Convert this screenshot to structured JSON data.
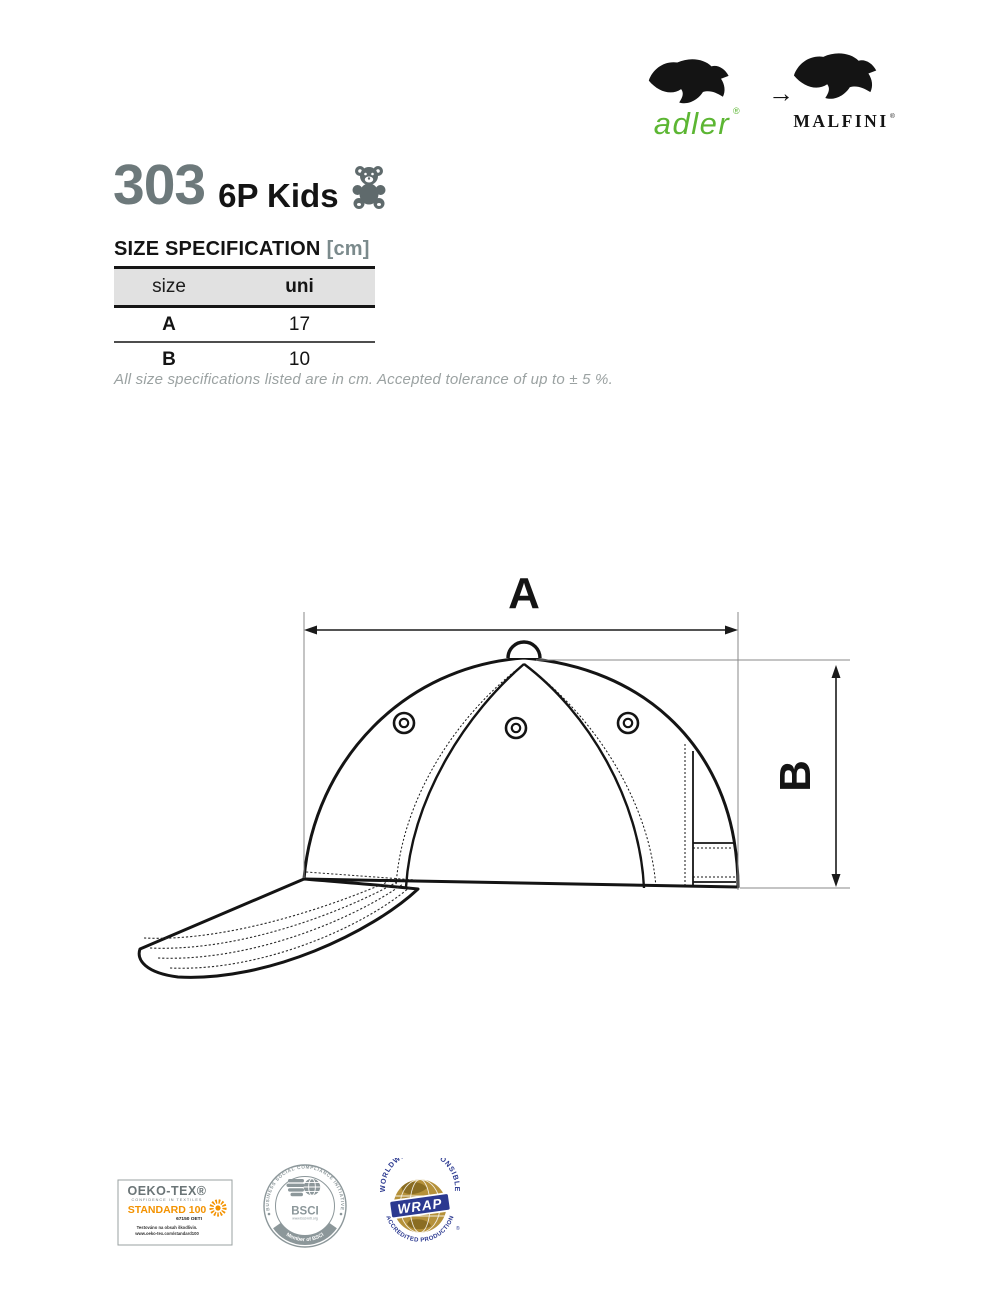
{
  "header": {
    "brand_from": {
      "name": "adler",
      "registered": "®",
      "color": "#5cb633"
    },
    "arrow": "→",
    "brand_to": {
      "name": "MALFINI",
      "registered": "®"
    }
  },
  "product": {
    "code": "303",
    "name": "6P Kids",
    "code_color": "#6d797b",
    "icon": "teddy-bear"
  },
  "size_spec": {
    "heading": "SIZE SPECIFICATION",
    "unit_label": "[cm]",
    "table": {
      "header": [
        "size",
        "uni"
      ],
      "rows": [
        [
          "A",
          "17"
        ],
        [
          "B",
          "10"
        ]
      ]
    },
    "note": "All size specifications listed are in cm. Accepted tolerance of up to ± 5 %."
  },
  "diagram": {
    "dim_a_label": "A",
    "dim_b_label": "B"
  },
  "certifications": {
    "oeko_tex": {
      "brand": "OEKO-TEX®",
      "subtitle": "CONFIDENCE IN TEXTILES",
      "standard": "STANDARD 100",
      "number": "67150 OETI",
      "line1": "Testováno na obsah škodlivin.",
      "line2": "www.oeko-tex.com/standard100",
      "orange": "#f39200",
      "gray": "#6b7577"
    },
    "bsci": {
      "ring_text": "BUSINESS SOCIAL COMPLIANCE INITIATIVE",
      "banner_text": "Member of BSCI",
      "center_label": "BSCI",
      "url": "www.bsci-intl.org",
      "color": "#8c979a"
    },
    "wrap": {
      "ring_text_top": "WORLDWIDE RESPONSIBLE",
      "ring_text_bottom": "ACCREDITED PRODUCTION",
      "banner_label": "WRAP",
      "registered": "®",
      "blue": "#2b3990",
      "gold": "#b5913a"
    }
  }
}
